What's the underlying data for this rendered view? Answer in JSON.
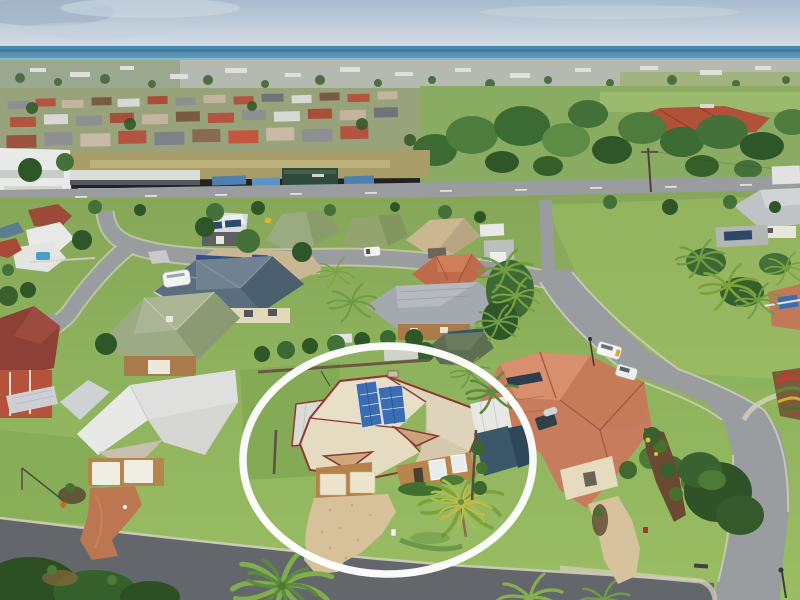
{
  "scene": {
    "setting": "Aerial drone photograph of a coastal suburban neighbourhood with ocean on the horizon",
    "annotation": {
      "shape": "ellipse",
      "cx": 388,
      "cy": 460,
      "rx": 145,
      "ry": 114,
      "stroke": "#ffffff",
      "stroke_width": 7.5
    },
    "landmarks": [
      {
        "id": "ocean-horizon",
        "desc": "Blue sea band across the horizon"
      },
      {
        "id": "distant-suburbs",
        "desc": "Dense distant rooftops between horizon and fields"
      },
      {
        "id": "school-complex",
        "desc": "Large red-roofed building complex among trees, upper right"
      },
      {
        "id": "commercial-strip",
        "desc": "White commercial buildings, car yard and sheds along main road, upper left"
      },
      {
        "id": "main-road",
        "desc": "Main road with white dashed centre line across the upper midground"
      },
      {
        "id": "residential-street",
        "desc": "Curving residential streets, cul-de-sac on left, corner junction bottom right"
      },
      {
        "id": "highlighted-house",
        "desc": "Cream tile-roof house with rooftop solar array, double garage, sandy driveway and palm tree, circled in white"
      },
      {
        "id": "left-neighbour-house",
        "desc": "House with pale grey roof, double garage, terracotta driveway"
      },
      {
        "id": "salmon-roof-house",
        "desc": "Large salmon tile-roof corner house with solar hot-water unit"
      },
      {
        "id": "blue-roof-house",
        "desc": "Dark blue-grey hip-roof house with caravan parked beside"
      },
      {
        "id": "green-roof-houses",
        "desc": "Sage-green roofed houses along the upper street"
      },
      {
        "id": "white-van",
        "desc": "White van parked on the right-hand street"
      },
      {
        "id": "white-suv",
        "desc": "White SUV parked behind the van"
      },
      {
        "id": "corner-flower-garden",
        "desc": "Terraced flower garden on the street corner, right edge"
      },
      {
        "id": "foreground-street",
        "desc": "Street along the bottom foreground with overhanging trees and a palm"
      }
    ]
  },
  "palette": {
    "sky-top": "#a9bbcd",
    "sky-mid": "#c9d4de",
    "sky-low": "#dfe5ea",
    "sea": "#4383a9",
    "sea-light": "#74a5c2",
    "dist-band": "#b5bab0",
    "field-tan": "#a89d68",
    "field-green": "#8aab62",
    "tree-dark": "#2f5628",
    "tree-mid": "#44703a",
    "tree-light": "#5d8c46",
    "lawn": "#8cb05c",
    "lawn-light": "#a4c468",
    "lawn-dark": "#6f9748",
    "road": "#999da0",
    "road-fore": "#63676b",
    "kerb": "#d3cebd",
    "roof-cream": "#e7dfc8",
    "roof-cream-dk": "#d6cbae",
    "maroon": "#8e3a33",
    "solar": "#3a6db4",
    "solar-dk": "#27527e",
    "brick": "#b3814d",
    "garage": "#ece4cd",
    "drive-sand": "#d7c19a",
    "drive-terra": "#bd7750",
    "roof-white": "#e9eae8",
    "roof-salmon": "#c87c5e",
    "roof-blue": "#5b6e80",
    "roof-green": "#9aab82",
    "roof-tan": "#cbb893",
    "roof-terra": "#bf6a4a",
    "roof-gray": "#a3a9ae",
    "shade-blue": "#3b5769",
    "annotation-white": "#ffffff"
  }
}
